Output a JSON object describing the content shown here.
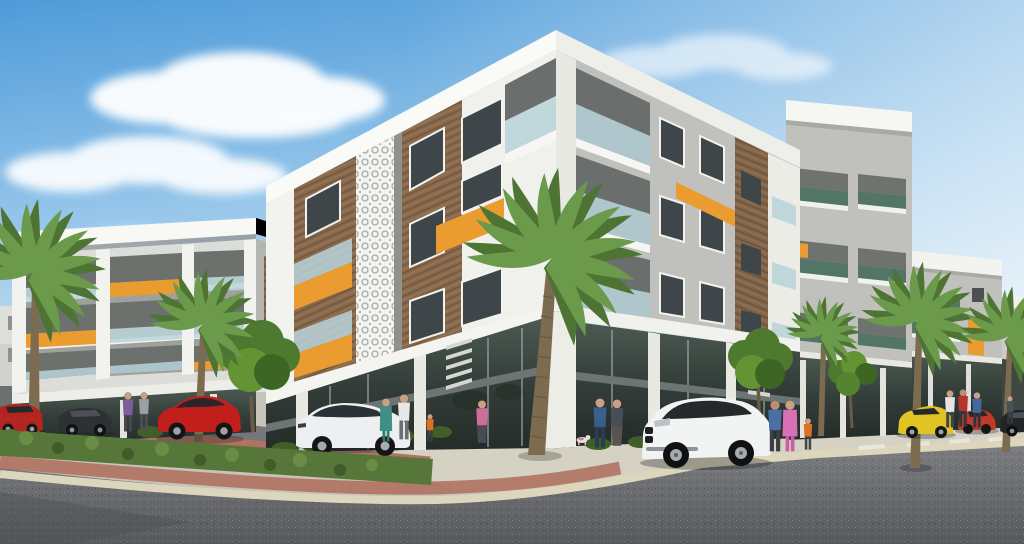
{
  "scene": {
    "type": "architectural-render",
    "description": "3D architectural rendering of a modern four-storey apartment complex on a street corner with ground-floor glass storefronts, decorative lattice panel, wood cladding, orange accent bands, palm trees, parked cars and pedestrians",
    "time_of_day": "day",
    "weather": "partly cloudy"
  },
  "palette": {
    "sky_top": "#4e9bd9",
    "sky_horizon": "#eaf3f8",
    "cloud": "#ffffff",
    "building_white": "#f8f8f4",
    "wall_left_face": "#d6d6d1",
    "wall_right_face": "#c0c1bc",
    "wall_a_face": "#dcddd8",
    "wall_gray_dark": "#9fa19c",
    "wood_panel": "#8a6a4d",
    "accent_orange": "#ea9c30",
    "lattice_white": "#f4f4f0",
    "window_glass": "#3e464a",
    "balcony_glass_blue": "#b8d3da",
    "balcony_glass_teal": "#4a6f60",
    "storefront_glass": "#343e3a",
    "beam_gray": "#6d7574",
    "pillar_white": "#e9e9e4",
    "sidewalk": "#d5d1c3",
    "paver_brick": "#b07262",
    "curb": "#dcd6bd",
    "hedge_green": "#57763a",
    "tree_green": "#4e7a2f",
    "palm_frond": "#6a9a4a",
    "palm_frond_dark": "#4d7433",
    "palm_trunk": "#7d6b50",
    "asphalt": "#7d7f82",
    "asphalt_dark": "#57595c",
    "lane_marking": "#e8e8e4",
    "hills_haze": "#b7c3c6"
  },
  "buildings": {
    "corner": {
      "floors": 4,
      "ground_floor": "retail storefronts",
      "features": [
        "white wrap-around roof slab",
        "decorative white lattice panel",
        "wood cladding strips",
        "orange balcony parapets",
        "corner balcony with glass railing"
      ]
    },
    "left": {
      "floors": 4,
      "features": [
        "recessed balconies",
        "glass railings",
        "staggered orange parapets"
      ]
    },
    "right_row": {
      "blocks": 3,
      "features": [
        "teal glass balconies",
        "white roof slabs",
        "retail glazing"
      ]
    }
  },
  "vehicles": [
    {
      "name": "red-sedan-far-left",
      "color": "#b3261f"
    },
    {
      "name": "dark-sedan",
      "color": "#2e3133"
    },
    {
      "name": "red-coupe",
      "color": "#c01f1c"
    },
    {
      "name": "white-hatchback",
      "color": "#edeff0"
    },
    {
      "name": "white-suv",
      "color": "#f2f3f3"
    },
    {
      "name": "yellow-hatchback",
      "color": "#e0c522"
    },
    {
      "name": "red-sedan-right",
      "color": "#bf3a28"
    },
    {
      "name": "black-sedan-right",
      "color": "#232526"
    }
  ],
  "people": [
    {
      "name": "man-blue-jacket",
      "shirt": "#3a5f8a",
      "pants": "#2c3b55"
    },
    {
      "name": "woman-dark-top",
      "shirt": "#474e55",
      "pants": "#5a5350"
    },
    {
      "name": "woman-pink-dress",
      "shirt": "#d970b5",
      "pants": "#c95fa4"
    },
    {
      "name": "man-blue-shirt",
      "shirt": "#4a6fa5",
      "pants": "#3a3f45"
    },
    {
      "name": "child-orange-shirt",
      "shirt": "#d9731f",
      "pants": "#474747"
    },
    {
      "name": "woman-teal-dress",
      "shirt": "#3f8f86",
      "pants": "#35776f"
    },
    {
      "name": "woman-white-top",
      "shirt": "#e8e8e6",
      "pants": "#6a6f74"
    },
    {
      "name": "child-orange-2",
      "shirt": "#d9731f",
      "pants": "#3c4043"
    },
    {
      "name": "woman-pink-top",
      "shirt": "#cf6d99",
      "pants": "#4a4a52"
    },
    {
      "name": "man-purple",
      "shirt": "#7a5f9a",
      "pants": "#46484e"
    },
    {
      "name": "person-gray",
      "shirt": "#9aa0a4",
      "pants": "#4c5156"
    },
    {
      "name": "man-white-shirt",
      "shirt": "#e5e6e4",
      "pants": "#3f454b"
    },
    {
      "name": "man-red-shirt",
      "shirt": "#b5342c",
      "pants": "#33383d"
    },
    {
      "name": "man-blue-2",
      "shirt": "#4468a0",
      "pants": "#2f3540"
    },
    {
      "name": "person-dark-distant",
      "shirt": "#4a5258",
      "pants": "#34393d"
    }
  ],
  "landscape": {
    "palm_trees": 6,
    "street_trees": 3,
    "median": "brick-paved island with trimmed hedge",
    "road": "asphalt with white lane dashes"
  }
}
